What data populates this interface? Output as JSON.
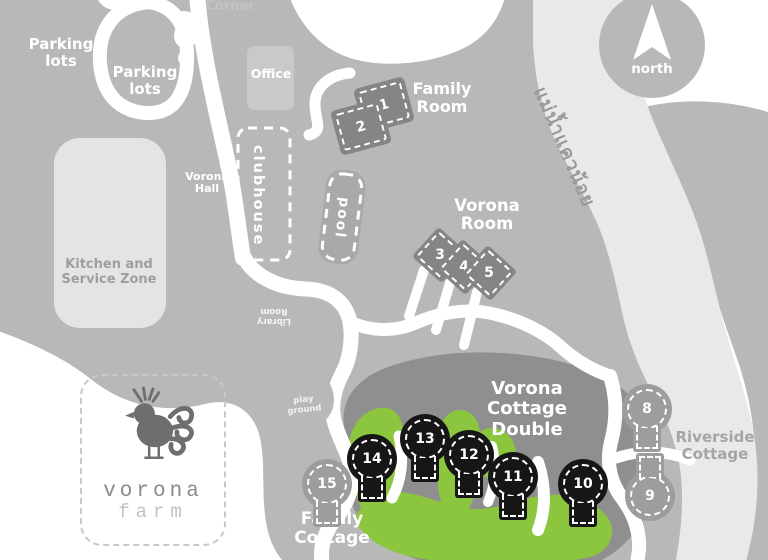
{
  "colors": {
    "land": "#b8b8b8",
    "river": "#e9e9e9",
    "pathwhite": "#ffffff",
    "darkzone": "#8f8f8f",
    "grass": "#8cc63f",
    "cottagedark": "#161616",
    "cottagegray": "#9d9d9d",
    "roomblock": "#858585",
    "kitchenblock": "#e4e4e4",
    "officeblock": "#c9c9c9",
    "poolblock": "#a9a9a9",
    "labelgray": "#9e9e9e",
    "faintgray": "#c3c3c3",
    "logogray": "#8a8a8a",
    "logofaint": "#c2c2c2"
  },
  "labels": {
    "corner": "Corner",
    "parking_lots_1": "Parking lots",
    "parking_lots_2": "Parking lots",
    "office": "Office",
    "family_room": "Family Room",
    "vorona_hall": "Vorona Hall",
    "clubhouse": "clubhouse",
    "pool": "pool",
    "vorona_room": "Vorona Room",
    "kitchen_zone": "Kitchen and Service Zone",
    "library_room": "Library Room",
    "play_ground": "play ground",
    "river_name_thai": "แม่น้ำแควน้อย",
    "north": "north",
    "vorona_cottage_double": "Vorona Cottage Double",
    "riverside_cottage": "Riverside Cottage",
    "family_cottage": "Family Cottage"
  },
  "logo": {
    "line1": "vorona",
    "line2": "farm"
  },
  "cottages": {
    "c1": "1",
    "c2": "2",
    "c3": "3",
    "c4": "4",
    "c5": "5",
    "c8": "8",
    "c9": "9",
    "c10": "10",
    "c11": "11",
    "c12": "12",
    "c13": "13",
    "c14": "14",
    "c15": "15"
  }
}
